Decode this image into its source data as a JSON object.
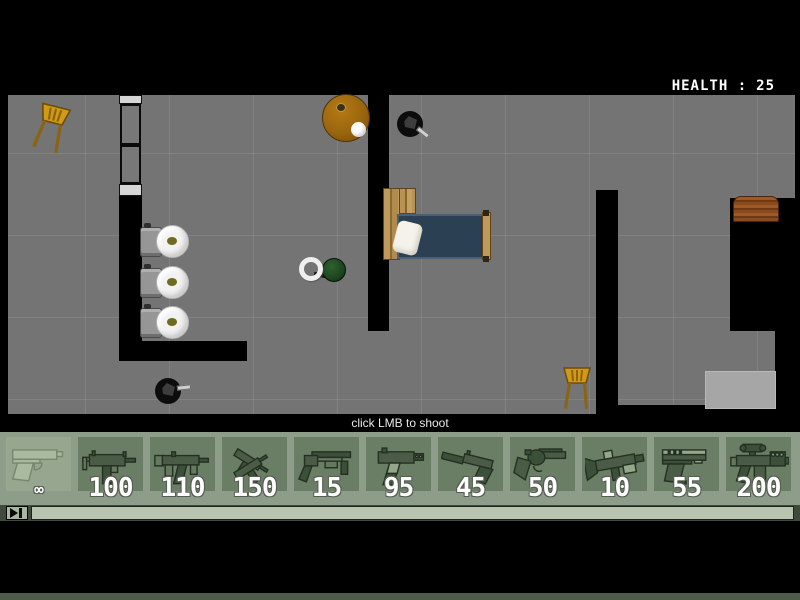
{
  "hud": {
    "health_label": "HEALTH :",
    "health_value": "25"
  },
  "hint_text": "click LMB to shoot",
  "weapon_bar": {
    "weapons": [
      {
        "id": "pistol",
        "icon": "pistol-icon",
        "ammo": "∞",
        "selected": true
      },
      {
        "id": "uzi",
        "icon": "uzi-icon",
        "ammo": "100",
        "selected": false
      },
      {
        "id": "mp5",
        "icon": "mp5-icon",
        "ammo": "110",
        "selected": false
      },
      {
        "id": "dual-uzis",
        "icon": "dual-uzis-icon",
        "ammo": "150",
        "selected": false
      },
      {
        "id": "shotgun",
        "icon": "shotgun-icon",
        "ammo": "15",
        "selected": false
      },
      {
        "id": "tec9",
        "icon": "tec9-icon",
        "ammo": "95",
        "selected": false
      },
      {
        "id": "silenced-pistol",
        "icon": "silenced-pistol-icon",
        "ammo": "45",
        "selected": false
      },
      {
        "id": "revolver",
        "icon": "revolver-icon",
        "ammo": "50",
        "selected": false
      },
      {
        "id": "rocket-launcher",
        "icon": "rocket-launcher-icon",
        "ammo": "10",
        "selected": false
      },
      {
        "id": "handgun",
        "icon": "handgun-icon",
        "ammo": "55",
        "selected": false
      },
      {
        "id": "scoped-rifle",
        "icon": "scoped-rifle-icon",
        "ammo": "200",
        "selected": false
      }
    ]
  },
  "colors": {
    "weapon_bar_bg": "#8e9d8a",
    "weapon_tile_bg": "#6a7d65",
    "weapon_tile_selected_bg": "#97a68f",
    "progress_bar_fill": "#b9c4b0",
    "floor": "#757474",
    "health_text": "#ffffff",
    "player": "#1c451d"
  }
}
